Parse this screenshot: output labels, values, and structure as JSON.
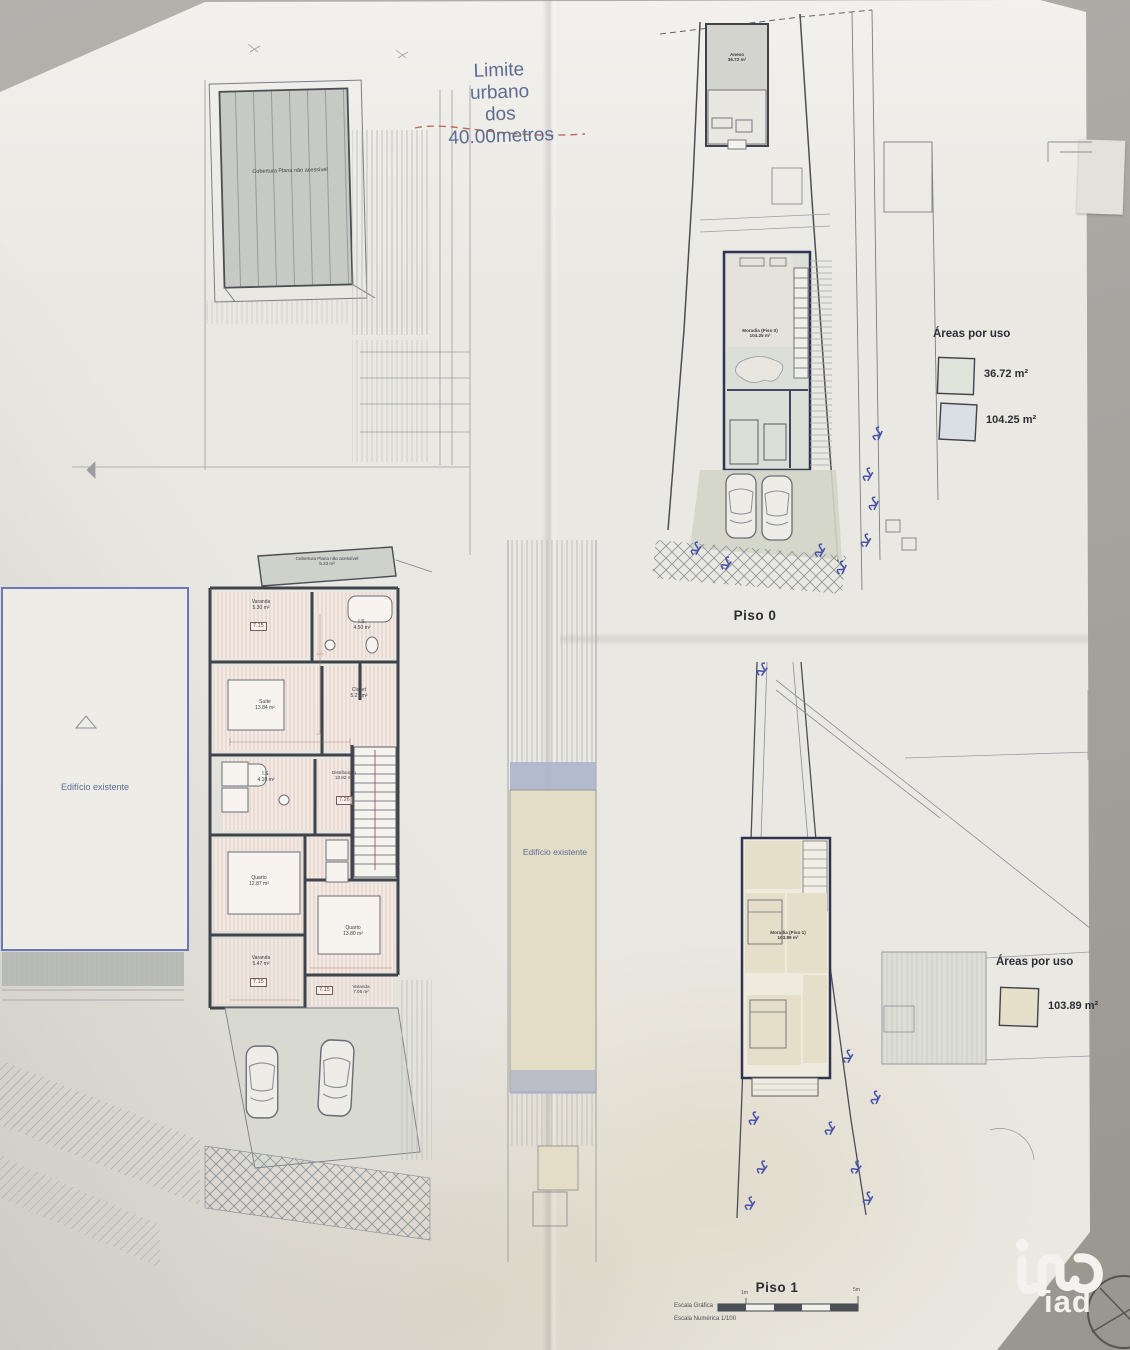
{
  "annotations": {
    "limite_urbano": "Limite\nurbano\ndos\n40.00metros",
    "edificio_existente_left": "Edifício existente",
    "edificio_existente_right": "Edifício existente"
  },
  "left_plan": {
    "roof_label": "Cobertura Plana não acessível",
    "roof_strip": {
      "name": "Cobertura Plana não acessível",
      "area": "5.23 m²"
    },
    "rooms": [
      {
        "name": "Varanda",
        "area": "5.30 m²",
        "level": "7.15"
      },
      {
        "name": "I.S.",
        "area": "4.50 m²"
      },
      {
        "name": "Suíte",
        "area": "13.84 m²"
      },
      {
        "name": "Closet",
        "area": "5.27 m²"
      },
      {
        "name": "I.S.",
        "area": "4.10 m²"
      },
      {
        "name": "Distribuição",
        "area": "13.82 m²",
        "level": "7.26"
      },
      {
        "name": "Quarto",
        "area": "12.87 m²"
      },
      {
        "name": "Quarto",
        "area": "13.80 m²"
      },
      {
        "name": "Varanda",
        "area": "5.47 m²",
        "level": "7.15"
      },
      {
        "name": "Varanda",
        "area": "7.05 m²",
        "level": "7.15"
      }
    ]
  },
  "piso0": {
    "title": "Piso 0",
    "anexo": {
      "name": "Anexo",
      "area": "36.72 m²"
    },
    "moradia": {
      "name": "Moradia (Piso 0)",
      "area": "104.25 m²"
    },
    "legend": {
      "title": "Áreas por uso",
      "items": [
        {
          "area": "36.72 m²",
          "color": "#dfe3d9"
        },
        {
          "area": "104.25 m²",
          "color": "#d9dfe5"
        }
      ]
    }
  },
  "piso1": {
    "title": "Piso 1",
    "moradia": {
      "name": "Moradia (Piso 1)",
      "area": "103.89 m²"
    },
    "legend": {
      "title": "Áreas por uso",
      "items": [
        {
          "area": "103.89 m²",
          "color": "#e6e0ca"
        }
      ]
    },
    "scale": {
      "graphic_label": "Escala Gráfica",
      "numeric_label": "Escala Numérica 1/100",
      "tick_min": "1m",
      "tick_max": "5m"
    }
  },
  "logo": {
    "text": "iad"
  },
  "colors": {
    "paper": "#eae8e2",
    "backdrop": "#a7a5a0",
    "note_blue": "#5d6c92",
    "dash_red": "#c06a5a",
    "beige": "#e4decb",
    "line_dark": "#3f434b"
  }
}
